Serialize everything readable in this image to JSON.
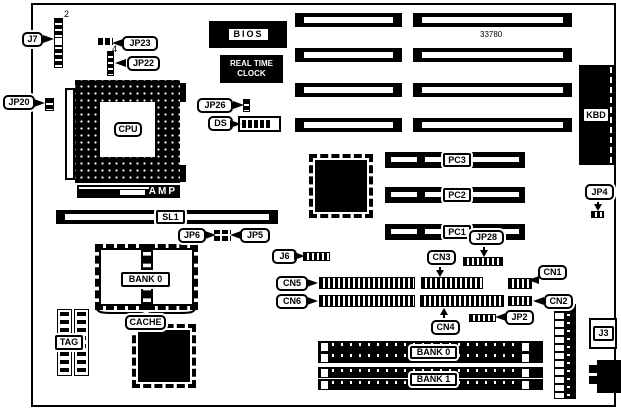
{
  "colors": {
    "ink": "#000000",
    "paper": "#ffffff"
  },
  "board": {
    "part_number": "33780"
  },
  "labels": {
    "j7": "J7",
    "pin2": "2",
    "jp23": "JP23",
    "pin4": "4",
    "jp22": "JP22",
    "jp20": "JP20",
    "cpu": "CPU",
    "amp": "AMP",
    "bios": "BIOS",
    "rtc1": "REAL TIME",
    "rtc2": "CLOCK",
    "jp26": "JP26",
    "ds": "DS",
    "kbd": "KBD",
    "pc3": "PC3",
    "pc2": "PC2",
    "pc1": "PC1",
    "jp4": "JP4",
    "jp28": "JP28",
    "sl1": "SL1",
    "jp6": "JP6",
    "jp5": "JP5",
    "bank0_cache": "BANK 0",
    "cache": "CACHE",
    "tag": "TAG",
    "j6": "J6",
    "cn5": "CN5",
    "cn6": "CN6",
    "cn3": "CN3",
    "cn4": "CN4",
    "cn1": "CN1",
    "cn2": "CN2",
    "jp2": "JP2",
    "bank0": "BANK 0",
    "bank1": "BANK 1",
    "j3": "J3"
  }
}
